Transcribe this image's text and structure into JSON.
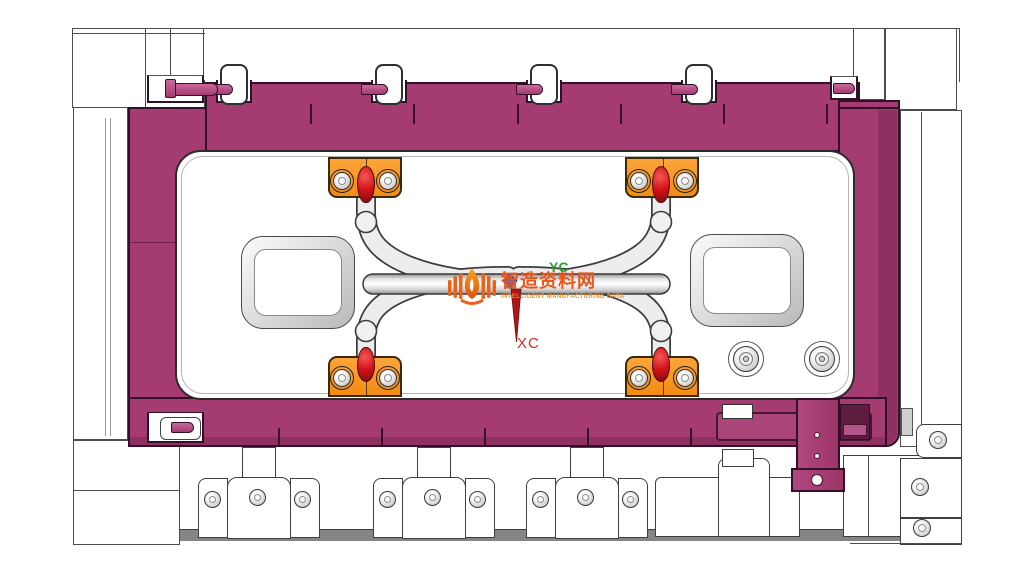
{
  "viewport": {
    "description": "CAD viewport of injection mold clamp plate assembly",
    "watermark": {
      "logo": "flame-book-logo",
      "title": "智造资料网",
      "subtitle": "INTELLIGENT MANUFACTURING DATA",
      "title_color": "#e8561c",
      "subtitle_color": "#ed8d1d"
    },
    "wcs": {
      "xc_label": "XC",
      "yc_label": "YC",
      "xc_color": "#d32a2a",
      "yc_color": "#2da02d",
      "origin_marker": "axis-origin-marker",
      "arrow": "xc-axis-arrow-down"
    },
    "colors": {
      "mold_frame_magenta": "#a43c71",
      "frame_shadow": "#8e3061",
      "frame_outline": "#33102a",
      "clamp_orange": "#f7941e",
      "pin_red": "#d01318",
      "tube_gray": "#ececec",
      "plate_white": "#ffffff",
      "outline_gray": "#4d4d4d"
    }
  }
}
